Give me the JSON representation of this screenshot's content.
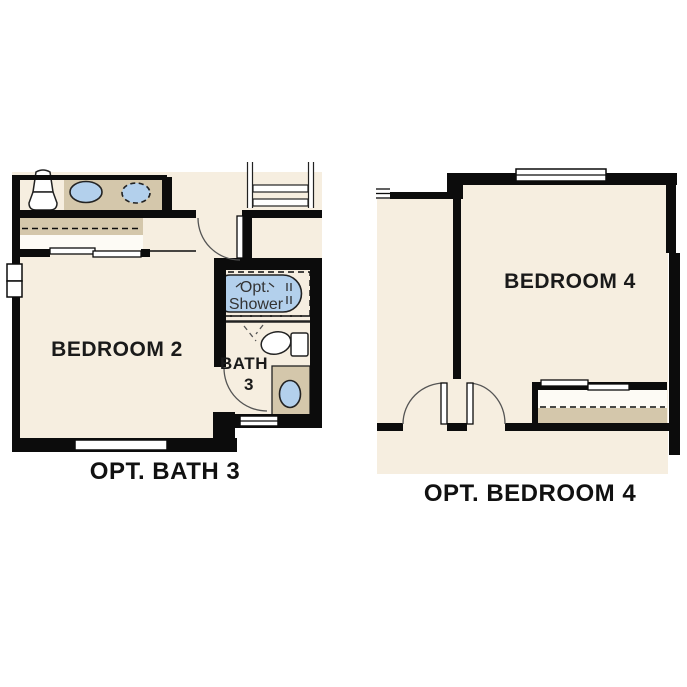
{
  "plans": {
    "left": {
      "title": "OPT. BATH 3",
      "room_label": "BEDROOM 2",
      "bath_label_line1": "BATH",
      "bath_label_line2": "3",
      "shower_label_line1": "Opt.",
      "shower_label_line2": "Shower"
    },
    "right": {
      "title": "OPT. BEDROOM 4",
      "room_label": "BEDROOM 4"
    }
  },
  "colors": {
    "floor": "#f6eee0",
    "wall": "#0c0c0c",
    "tan": "#d4c7ab",
    "blue": "#b3d0ec",
    "outline": "#222222",
    "arc": "#555555",
    "text": "#1a1a1a",
    "shtext": "#333333"
  }
}
